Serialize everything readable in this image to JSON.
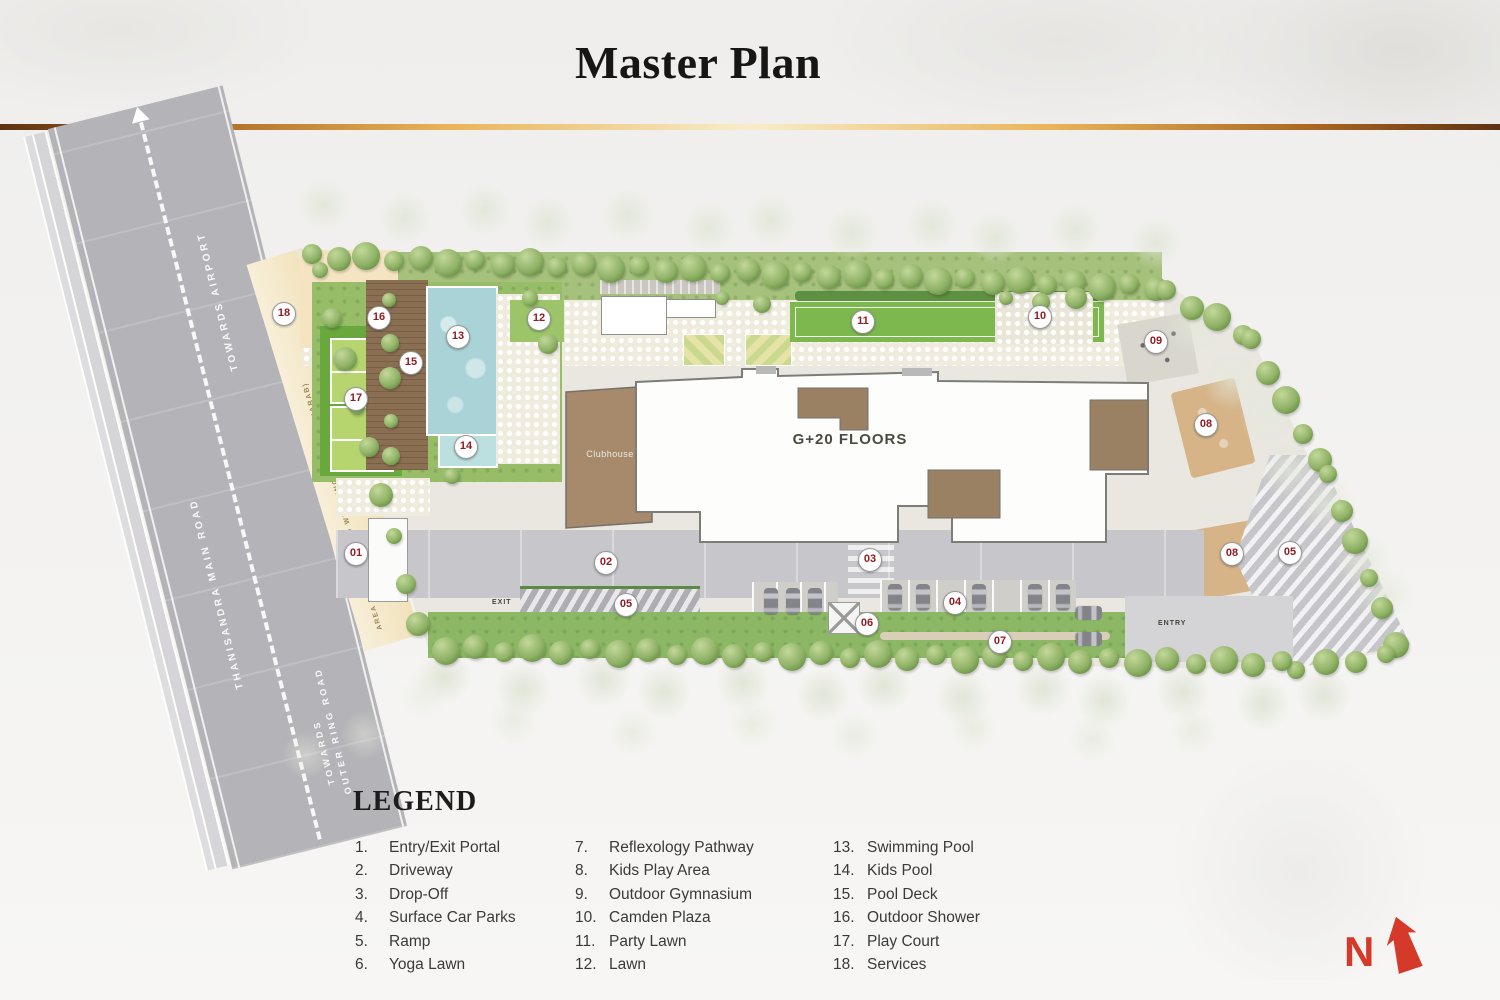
{
  "header": {
    "title": "Master Plan"
  },
  "plan": {
    "building_label": "G+20 FLOORS",
    "clubhouse_label": "Clubhouse",
    "entry_label": "ENTRY",
    "exit_label": "EXIT",
    "north_label": "N",
    "roads": {
      "towards_airport": "TOWARDS AIRPORT",
      "main_road": "THANISANDRA MAIN ROAD",
      "towards_outer_line1": "TOWARDS",
      "towards_outer_line2": "OUTER RING ROAD",
      "widening_note": "AREA LEFT FOR ROAD WIDENING - (30MTRS KHARAB)"
    },
    "markers": [
      {
        "num": "01",
        "x": 355,
        "y": 553
      },
      {
        "num": "02",
        "x": 605,
        "y": 562
      },
      {
        "num": "03",
        "x": 869,
        "y": 559
      },
      {
        "num": "04",
        "x": 954,
        "y": 602
      },
      {
        "num": "05",
        "x": 625,
        "y": 604
      },
      {
        "num": "05",
        "x": 1289,
        "y": 552
      },
      {
        "num": "06",
        "x": 866,
        "y": 623
      },
      {
        "num": "07",
        "x": 999,
        "y": 641
      },
      {
        "num": "08",
        "x": 1205,
        "y": 424
      },
      {
        "num": "08",
        "x": 1231,
        "y": 553
      },
      {
        "num": "09",
        "x": 1155,
        "y": 341
      },
      {
        "num": "10",
        "x": 1039,
        "y": 316
      },
      {
        "num": "11",
        "x": 862,
        "y": 321
      },
      {
        "num": "12",
        "x": 538,
        "y": 318
      },
      {
        "num": "13",
        "x": 457,
        "y": 336
      },
      {
        "num": "14",
        "x": 465,
        "y": 446
      },
      {
        "num": "15",
        "x": 410,
        "y": 362
      },
      {
        "num": "16",
        "x": 378,
        "y": 317
      },
      {
        "num": "17",
        "x": 355,
        "y": 398
      },
      {
        "num": "18",
        "x": 283,
        "y": 313
      }
    ]
  },
  "legend": {
    "title": "LEGEND",
    "columns": [
      {
        "items": [
          {
            "num": "1.",
            "label": "Entry/Exit Portal"
          },
          {
            "num": "2.",
            "label": "Driveway"
          },
          {
            "num": "3.",
            "label": "Drop-Off"
          },
          {
            "num": "4.",
            "label": "Surface Car Parks"
          },
          {
            "num": "5.",
            "label": "Ramp"
          },
          {
            "num": "6.",
            "label": "Yoga Lawn"
          }
        ]
      },
      {
        "items": [
          {
            "num": "7.",
            "label": "Reflexology Pathway"
          },
          {
            "num": "8.",
            "label": "Kids Play Area"
          },
          {
            "num": "9.",
            "label": "Outdoor Gymnasium"
          },
          {
            "num": "10.",
            "label": "Camden Plaza"
          },
          {
            "num": "11.",
            "label": "Party Lawn"
          },
          {
            "num": "12.",
            "label": "Lawn"
          }
        ]
      },
      {
        "items": [
          {
            "num": "13.",
            "label": "Swimming Pool"
          },
          {
            "num": "14.",
            "label": "Kids Pool"
          },
          {
            "num": "15.",
            "label": "Pool Deck"
          },
          {
            "num": "16.",
            "label": "Outdoor Shower"
          },
          {
            "num": "17.",
            "label": "Play Court"
          },
          {
            "num": "18.",
            "label": "Services"
          }
        ]
      }
    ]
  },
  "colors": {
    "marker_red": "#8f1d23",
    "north_red": "#d5392a",
    "road_gray": "#b4b3b7",
    "pool_blue": "#a9d3d6",
    "lawn_green": "#7cb84e",
    "deck_brown": "#8a6f52",
    "widening_beige": "#f1e2ba",
    "site_paving": "#e9e7e0",
    "tree_green": "#7da659",
    "divider_gold": "#e9b45a",
    "building_white": "#fdfdfc"
  }
}
